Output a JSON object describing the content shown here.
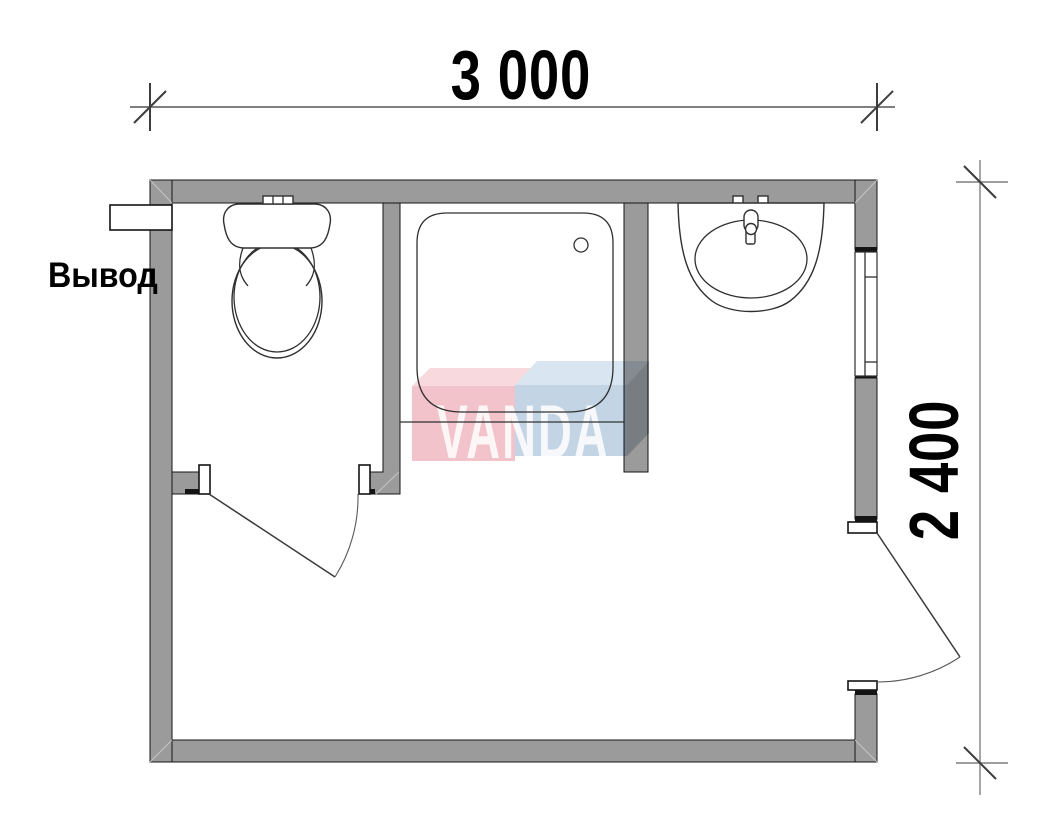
{
  "dimensions": {
    "width": {
      "label": "3 000"
    },
    "height": {
      "label": "2 400"
    }
  },
  "outlet": {
    "label": "Вывод"
  },
  "watermark": {
    "text": "VANDA",
    "pink": "#f2c3ca",
    "pink_top": "#f7d9de",
    "blue": "#c3d4e5",
    "blue_top": "#d9e5f1",
    "blue_side": "#c3cdd5",
    "letter_color": "#ffffff"
  },
  "colors": {
    "wall": "#9b9b9b",
    "outline": "#141414",
    "fixture_line": "#303030",
    "dimension_line": "#7f7f7f",
    "tick": "#3d3d3d",
    "label_text": "#000000"
  },
  "fixtures": {
    "toilet": "toilet",
    "shower": "shower-tray",
    "washbasin": "washbasin",
    "window": "window",
    "interior_door": "interior-door",
    "exterior_door": "exterior-door",
    "outlet_pipe": "outlet-pipe"
  }
}
